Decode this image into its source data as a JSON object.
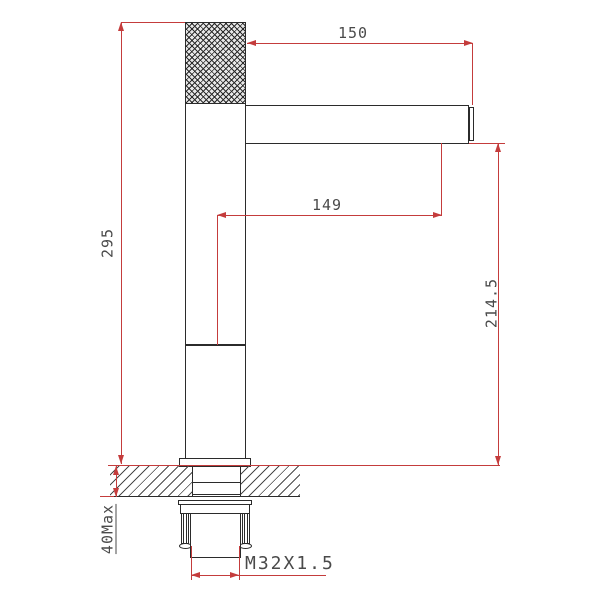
{
  "drawing": {
    "type": "faucet-installation-technical-drawing",
    "labels": {
      "overall_height": "295",
      "top_reach": "150",
      "spout_reach": "149",
      "spout_height": "214.5",
      "deck_thickness": "40Max",
      "thread_spec": "M32X1.5"
    },
    "colors": {
      "dimension_red": "#c43c3c",
      "outline_black": "#2b2b2b",
      "text_gray": "#4a4a4a",
      "background": "#ffffff"
    }
  }
}
